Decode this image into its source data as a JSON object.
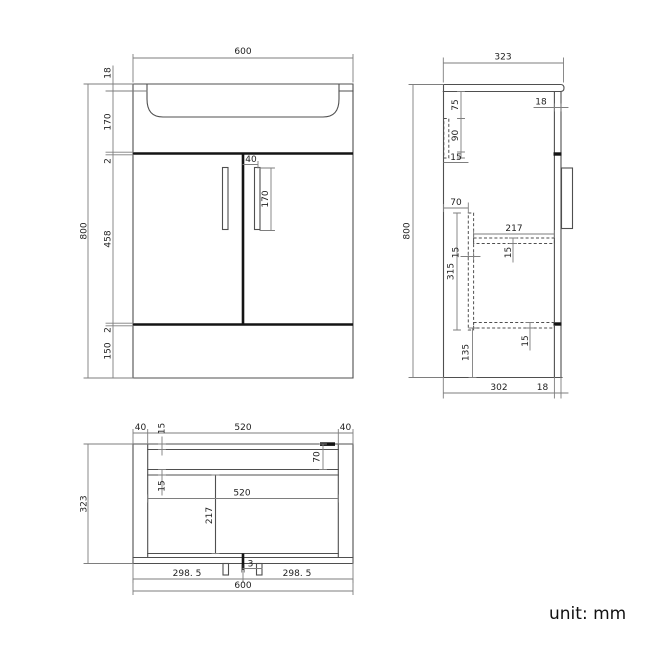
{
  "unit_label": "unit: mm",
  "front_view": {
    "overall_width": "600",
    "overall_height": "800",
    "counter_thickness": "18",
    "basin_height": "170",
    "gap_top": "2",
    "door_height": "458",
    "gap_bottom": "2",
    "plinth_height": "150",
    "handle_offset": "40",
    "handle_length": "170"
  },
  "side_view": {
    "overall_depth": "323",
    "overall_height": "800",
    "door_thickness": "18",
    "backboard_top_offset": "75",
    "backboard_height": "90",
    "backboard_width": "15",
    "divider_back_offset": "70",
    "divider_height": "315",
    "divider_thickness": "15",
    "shelf_depth": "217",
    "shelf_thickness": "15",
    "bottom_shelf_thickness": "15",
    "bottom_clearance": "135",
    "carcass_depth": "302",
    "front_thickness": "18"
  },
  "plan_view": {
    "side_panel_left": "40",
    "back_rail_thickness": "15",
    "interior_width": "520",
    "side_panel_right": "40",
    "overall_depth": "323",
    "back_offset": "70",
    "rail_thickness": "15",
    "interior_width_mid": "520",
    "shelf_depth": "217",
    "door_gap": "3",
    "left_door_width": "298. 5",
    "right_door_width": "298. 5",
    "overall_width": "600"
  }
}
